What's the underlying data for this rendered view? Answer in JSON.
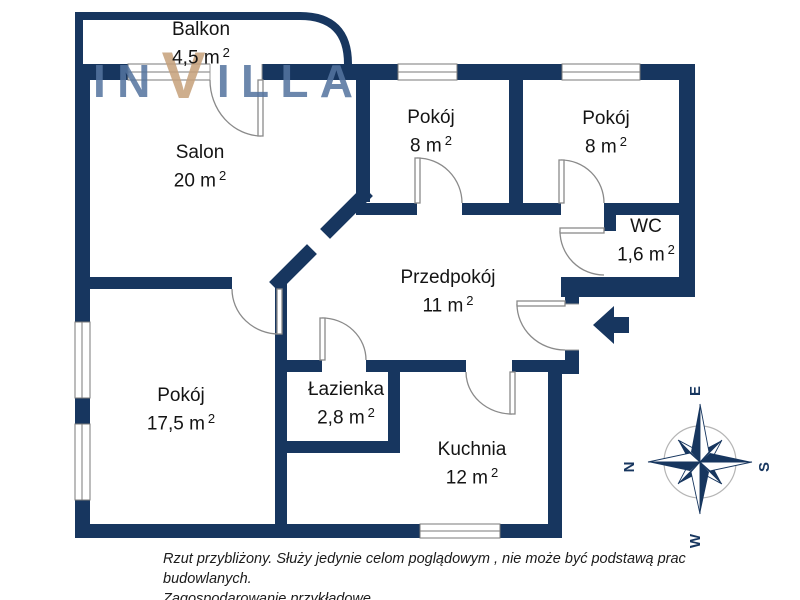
{
  "logo": {
    "letters": [
      "I",
      "N",
      "V",
      "I",
      "L",
      "L",
      "A"
    ]
  },
  "unit": {
    "m": "m",
    "sup": "2"
  },
  "rooms": [
    {
      "name": "Balkon",
      "area": "4,5"
    },
    {
      "name": "Salon",
      "area": "20"
    },
    {
      "name": "Pokój",
      "area": "8"
    },
    {
      "name": "Pokój",
      "area": "8"
    },
    {
      "name": "WC",
      "area": "1,6"
    },
    {
      "name": "Przedpokój",
      "area": "11"
    },
    {
      "name": "Pokój",
      "area": "17,5"
    },
    {
      "name": "Łazienka",
      "area": "2,8"
    },
    {
      "name": "Kuchnia",
      "area": "12"
    }
  ],
  "compass": {
    "n": "N",
    "e": "E",
    "s": "S",
    "w": "W"
  },
  "disclaimer": {
    "line1": "Rzut przybliżony. Służy jedynie celom poglądowym , nie może być podstawą prac budowlanych.",
    "line2": "Zagospodarowanie przykładowe."
  },
  "colors": {
    "wall": "#17365F",
    "logo_blue": "#54749F",
    "logo_tan": "#C6A17B",
    "door_line": "#8A8A8A",
    "text": "#141414"
  }
}
